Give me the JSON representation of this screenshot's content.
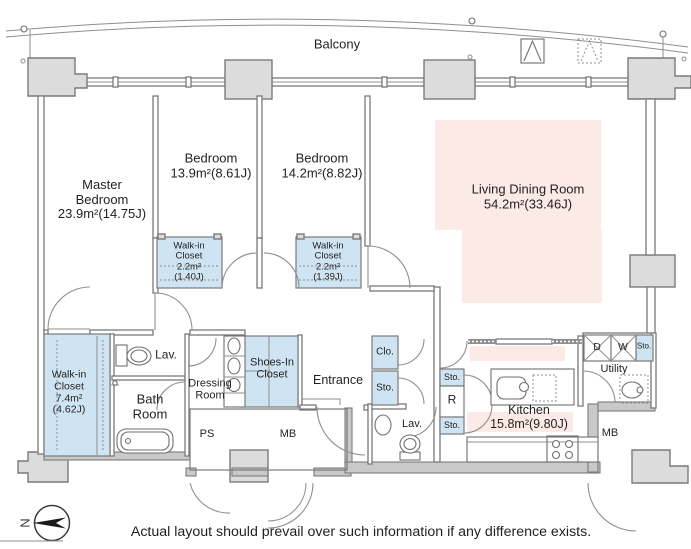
{
  "colors": {
    "wall": "#7a7a7a",
    "column_fill": "#dcdcdc",
    "closet_fill": "#cfe4f2",
    "highlight_pink": "#fceae7",
    "thick_wall_fill": "#c9c9c9",
    "ink": "#231f20"
  },
  "balcony": {
    "label": "Balcony"
  },
  "rooms": {
    "master_bedroom": "Master\nBedroom\n23.9m²(14.75J)",
    "bedroom_2": "Bedroom\n13.9m²(8.61J)",
    "bedroom_3": "Bedroom\n14.2m²(8.82J)",
    "living_dining": "Living Dining Room\n54.2m²(33.46J)",
    "kitchen": "Kitchen\n15.8m²(9.80J)",
    "wic_master": "Walk-in\nCloset\n7.4m²\n(4.62J)",
    "wic_bedroom_2": "Walk-in\nCloset\n2.2m²\n(1.40J)",
    "wic_bedroom_3": "Walk-in\nCloset\n2.2m²\n(1.39J)",
    "bath": "Bath\nRoom",
    "lav_1": "Lav.",
    "lav_2": "Lav.",
    "dressing": "Dressing\nRoom",
    "shoes_closet": "Shoes-In\nCloset",
    "entrance": "Entrance",
    "utility": "Utility"
  },
  "small_labels": {
    "clo": "Clo.",
    "sto": "Sto.",
    "refrigerator": "R",
    "dryer": "D",
    "washer": "W",
    "ps": "PS",
    "mb": "MB",
    "north": "N"
  },
  "footer": {
    "disclaimer": "Actual layout should prevail over such information if any difference exists."
  }
}
